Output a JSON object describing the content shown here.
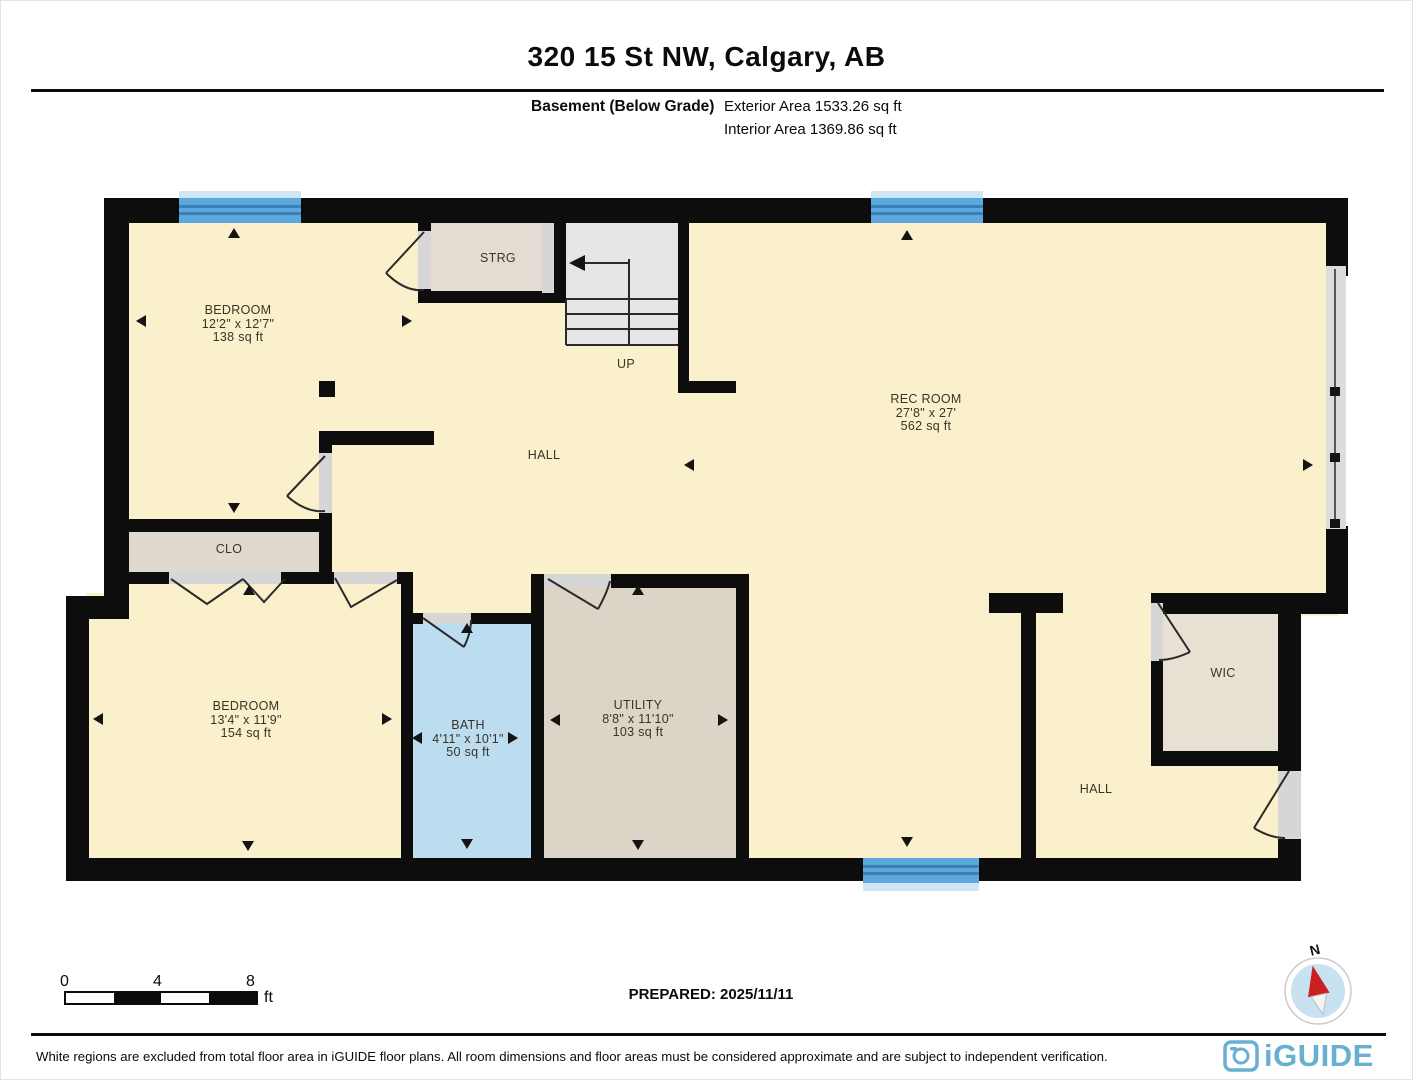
{
  "header": {
    "title": "320 15 St NW, Calgary, AB",
    "floor_label": "Basement (Below Grade)",
    "exterior_area": "Exterior Area 1533.26 sq ft",
    "interior_area": "Interior Area 1369.86 sq ft"
  },
  "rooms": {
    "bedroom_upper": {
      "name": "BEDROOM",
      "dims": "12'2\" x 12'7\"",
      "area": "138 sq ft"
    },
    "strg": {
      "name": "STRG"
    },
    "stairs": {
      "label": "UP"
    },
    "rec_room": {
      "name": "REC ROOM",
      "dims": "27'8\" x 27'",
      "area": "562 sq ft"
    },
    "hall": {
      "name": "HALL"
    },
    "clo": {
      "name": "CLO"
    },
    "bedroom_lower": {
      "name": "BEDROOM",
      "dims": "13'4\" x 11'9\"",
      "area": "154 sq ft"
    },
    "bath": {
      "name": "BATH",
      "dims": "4'11\" x 10'1\"",
      "area": "50 sq ft"
    },
    "utility": {
      "name": "UTILITY",
      "dims": "8'8\" x 11'10\"",
      "area": "103 sq ft"
    },
    "wic": {
      "name": "WIC"
    },
    "hall_right": {
      "name": "HALL"
    }
  },
  "scale_bar": {
    "labels": [
      "0",
      "4",
      "8"
    ],
    "unit": "ft"
  },
  "footer": {
    "prepared": "PREPARED: 2025/11/11",
    "disclaimer": "White regions are excluded from total floor area in iGUIDE floor plans. All room dimensions and floor areas must be considered approximate and are subject to independent verification.",
    "brand": "iGUIDE",
    "compass_north": "N"
  },
  "colors": {
    "room_cream": "#faf0cb",
    "room_gray_beige": "#e1dbce",
    "bath_blue": "#bcdcf0",
    "window_blue": "#5ca8dc",
    "wall_black": "#0d0d0d",
    "brand_blue": "#69afd2",
    "compass_red": "#cc1f1f"
  }
}
